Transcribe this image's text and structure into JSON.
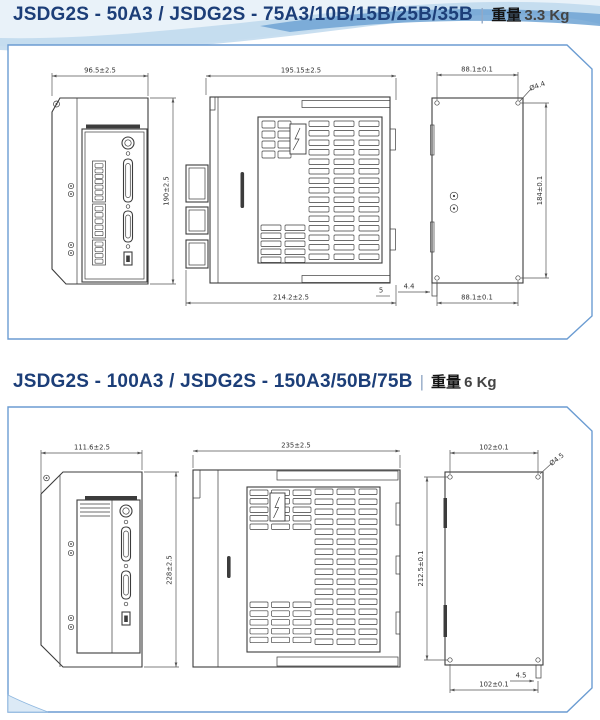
{
  "page": {
    "separator": "|",
    "accent_color": "#1c3e78",
    "panel_border_color": "#6b9cd2",
    "drawing_color": "#3c3c3c"
  },
  "sections": [
    {
      "title": "JSDG2S - 50A3 / JSDG2S - 75A3/10B/15B/25B/35B",
      "weight_label": "重量",
      "weight_value": "3.3 Kg",
      "views": {
        "front": {
          "width_dim": "96.5±2.5",
          "height_dim": "190±2.5"
        },
        "side": {
          "depth_dim": "195.15±2.5",
          "total_depth_dim": "214.2±2.5",
          "edge_offset_dim": "5"
        },
        "rear": {
          "top_hole_span_dim": "88.1±0.1",
          "bottom_hole_span_dim": "88.1±0.1",
          "hole_diameter": "Ø4.4",
          "hole_span_height_dim": "184±0.1",
          "tab_width_dim": "4.4"
        }
      }
    },
    {
      "title": "JSDG2S - 100A3 / JSDG2S - 150A3/50B/75B",
      "weight_label": "重量",
      "weight_value": "6 Kg",
      "views": {
        "front": {
          "width_dim": "111.6±2.5",
          "height_dim": "228±2.5"
        },
        "side": {
          "depth_dim": "235±2.5"
        },
        "rear": {
          "top_hole_span_dim": "102±0.1",
          "bottom_hole_span_dim": "102±0.1",
          "hole_diameter": "Ø4.5",
          "hole_span_height_dim": "212.5±0.1",
          "tab_width_dim": "4.5"
        }
      }
    }
  ]
}
